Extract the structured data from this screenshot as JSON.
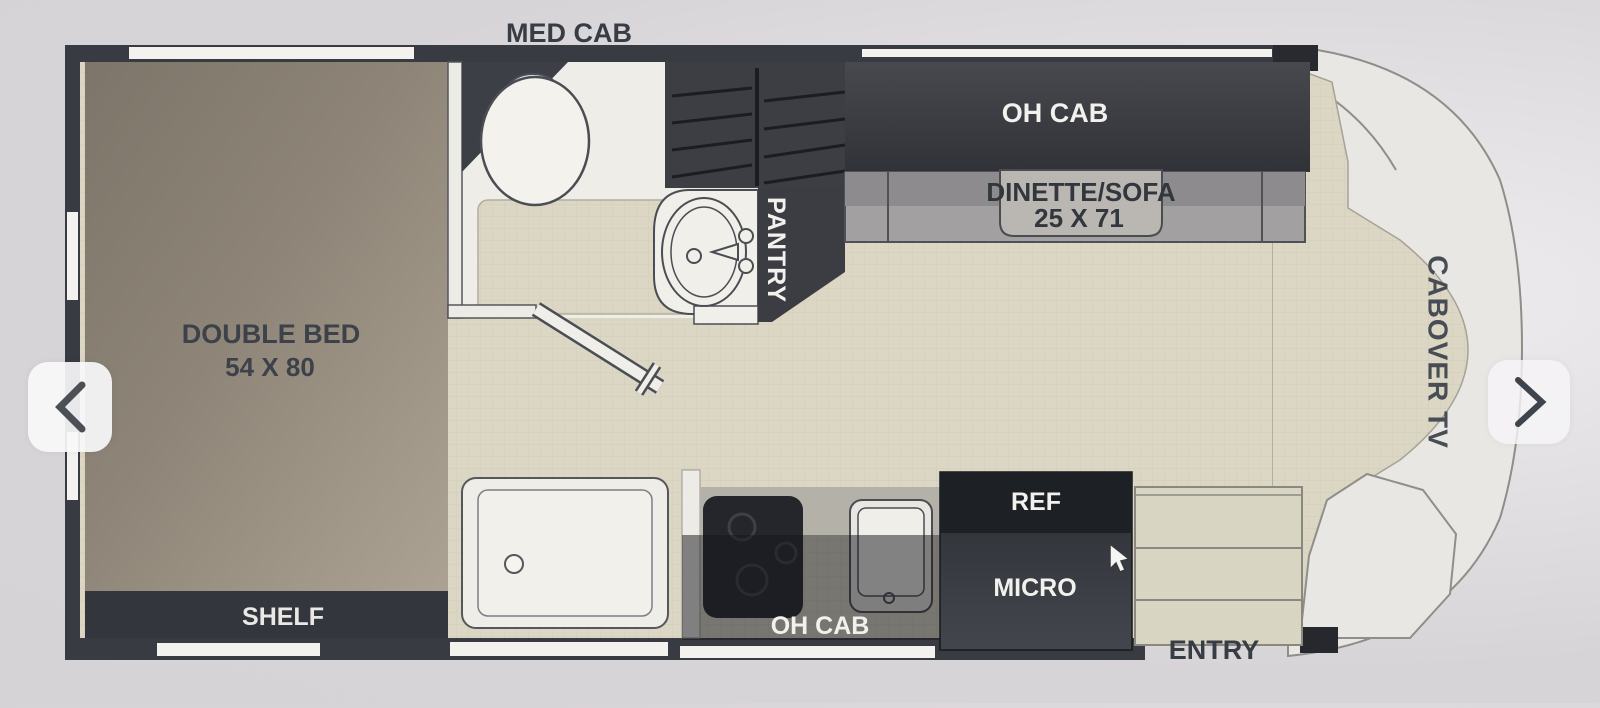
{
  "viewer": {
    "prev_button": {
      "icon": "chevron-left-icon"
    },
    "next_button": {
      "icon": "chevron-right-icon"
    },
    "cursor": {
      "icon": "mouse-pointer-icon"
    }
  },
  "floorplan": {
    "labels": {
      "med_cab": "MED CAB",
      "oh_cab_top": "OH CAB",
      "dinette_sofa": "DINETTE/SOFA",
      "dinette_dims": "25 X 71",
      "pantry": "PANTRY",
      "cabover_tv": "CABOVER TV",
      "double_bed": "DOUBLE BED",
      "bed_dims": "54 X 80",
      "shelf": "SHELF",
      "ref": "REF",
      "micro": "MICRO",
      "oh_cab_bottom": "OH CAB",
      "entry": "ENTRY"
    },
    "colors": {
      "wall": "#383b42",
      "floor": "#dbd7c4",
      "cabinet_dark": "#3c3e44",
      "bed": "#958c7e",
      "sofa": "#a3a0a2",
      "appliance_dark": "#1d2025",
      "label_dark": "#383d46",
      "label_light": "#f2f1ee"
    }
  }
}
